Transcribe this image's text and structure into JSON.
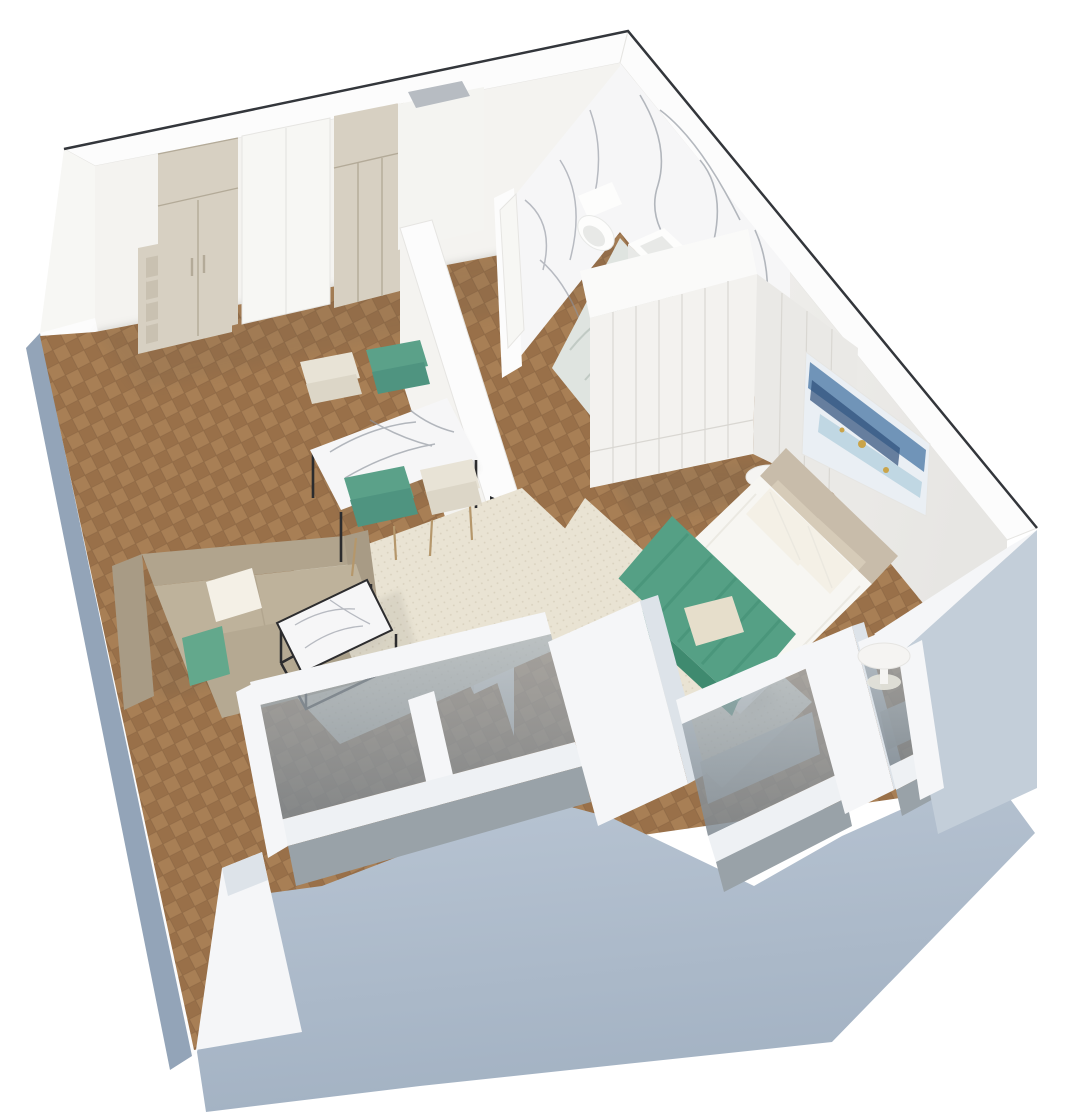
{
  "palette": {
    "bg": "#ffffff",
    "ink": "#33363b",
    "wall_top": "#fcfcfc",
    "wall_top_edge": "#e6e5e2",
    "wall_face": "#f4f3f0",
    "wall_face_dark": "#e7e6e3",
    "ext_light": "#bac6d4",
    "ext_mid": "#a3b2c3",
    "ext_dark": "#93a4b8",
    "ext_corner": "#c3ced9",
    "niche": "#ccd2da",
    "wood_a": "#a87f55",
    "wood_b": "#997049",
    "wood_seam": "#815f3e",
    "marble": "#f6f6f7",
    "marble_vein": "#8d939d",
    "marble_floor": "#dfe4e0",
    "marble_floor_vein": "#b9c3bd",
    "ward_beige": "#d7d0c2",
    "ward_beige_dark": "#c9c1b1",
    "ward_seam": "#b3aa98",
    "ward_white": "#f3f2ef",
    "ward_white_side": "#eae9e6",
    "ward_white_seam": "#d9d7d2",
    "ward_white_top": "#fafaf9",
    "door_white": "#f7f7f4",
    "duct_face": "#f4f4f1",
    "duct_open": "#b7bcc2",
    "rug": "#e9e3d3",
    "rug_dot": "#d8d0bd",
    "sofa_dark": "#a89b85",
    "sofa_mid": "#b1a48d",
    "sofa_light": "#beb29b",
    "sofa_chaise": "#b5a992",
    "pillow_white": "#f4f0e6",
    "pillow_green": "#63a88c",
    "throw": "#55a085",
    "throw_dark": "#3f8a6f",
    "bed_white": "#f7f6f2",
    "bed_shade": "#e6e4dc",
    "headboard": "#c8bcaa",
    "cushion": "#d6cbb8",
    "accent_pillow": "#e6decb",
    "chair_green": "#5ba189",
    "chair_green_dark": "#4f9480",
    "chair_cream": "#e8e3d6",
    "chair_cream_dark": "#dcd6c7",
    "chair_leg": "#b5976b",
    "table_black": "#2c2c2e",
    "tv": "#26282b",
    "tv_sheen": "#3d4045",
    "unit_white": "#f5f4f2",
    "unit_side": "#e8e7e3",
    "art_bg": "#eaeff4",
    "art_blue": "#5b84ad",
    "art_navy": "#2d4f79",
    "art_teal": "#9cc3d5",
    "art_gold": "#c9a44a",
    "glass_a": "#aab4bc",
    "glass_b": "#7e8890",
    "sill": "#eef1f4",
    "parapet": "#99a2a8",
    "radiator": "#c9cdcd",
    "pier": "#f5f6f8",
    "pier_shade": "#dde3e9",
    "toilet": "#fdfdfc",
    "fix_shade": "#e8e9e7",
    "shadow": "#55554d"
  }
}
